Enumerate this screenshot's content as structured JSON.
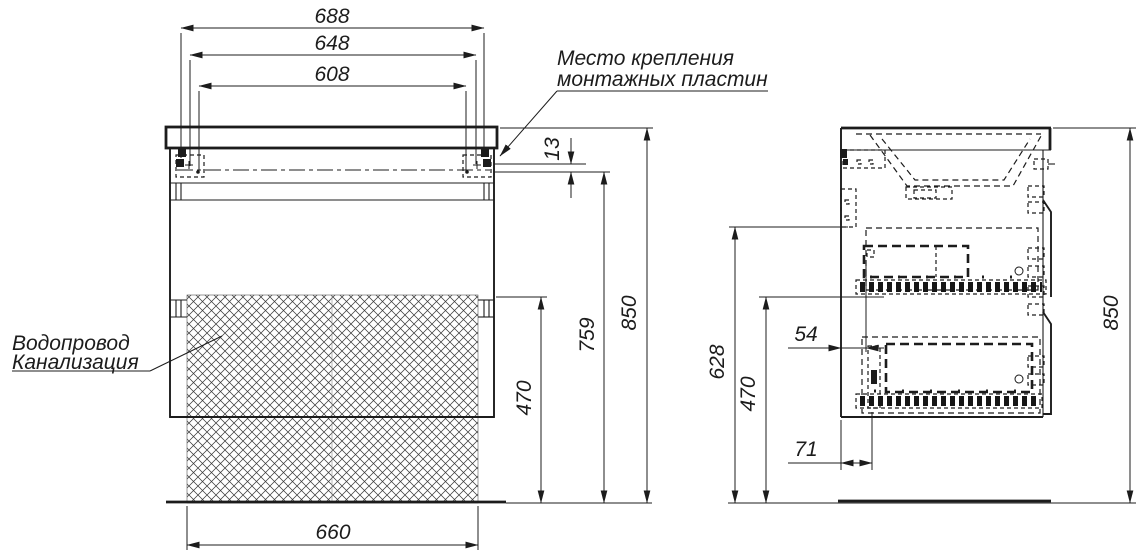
{
  "notes": {
    "mounting_line1": "Место крепления",
    "mounting_line2": "монтажных пластин",
    "plumbing_line1": "Водопровод",
    "plumbing_line2": "Канализация"
  },
  "front": {
    "top_width": "688",
    "mid_width": "648",
    "inner_width": "608",
    "plate_offset": "13",
    "mount_height": "759",
    "total_height": "850",
    "zone_height": "470",
    "bottom_width": "660"
  },
  "side": {
    "back_height": "628",
    "zone_height": "470",
    "total_height": "850",
    "top_inset": "54",
    "bottom_inset": "71"
  },
  "colors": {
    "line": "#1c1c1c",
    "background": "#ffffff"
  }
}
